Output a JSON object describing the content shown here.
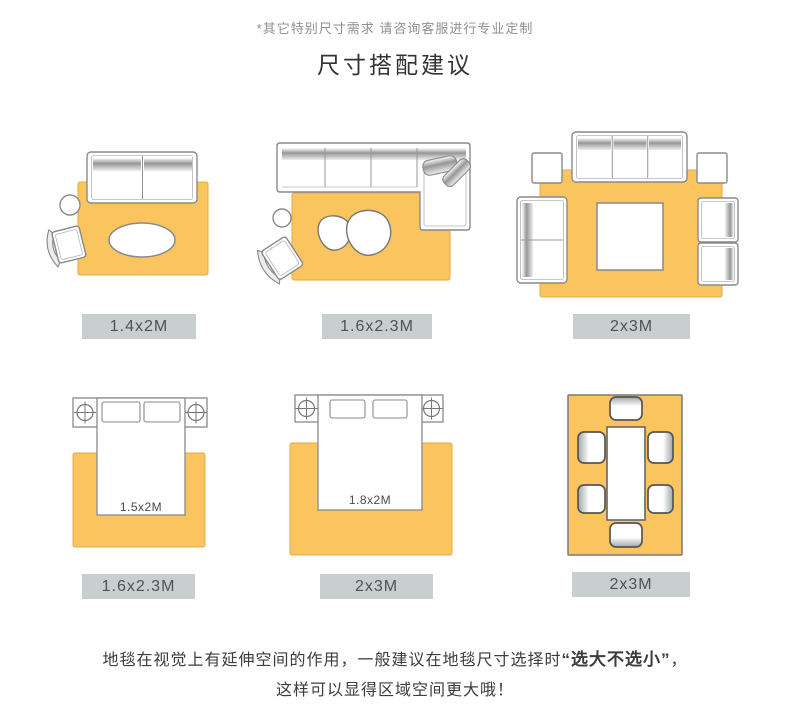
{
  "note": "*其它特别尺寸需求 请咨询客服进行专业定制",
  "title": "尺寸搭配建议",
  "diagrams": [
    {
      "label": "1.4x2M"
    },
    {
      "label": "1.6x2.3M"
    },
    {
      "label": "2x3M"
    },
    {
      "label": "1.6x2.3M",
      "bed_size": "1.5x2M"
    },
    {
      "label": "2x3M",
      "bed_size": "1.8x2M"
    },
    {
      "label": "2x3M"
    }
  ],
  "footer": {
    "line1_prefix": "地毯在视觉上有延伸空间的作用，一般建议在地毯尺寸选择时",
    "line1_bold": "“选大不选小”",
    "line1_suffix": "，",
    "line2": "这样可以显得区域空间更大哦！"
  },
  "colors": {
    "rug_fill": "#FAC55F",
    "rug_border": "#E3AC43",
    "outline_gray": "#8A8A8A",
    "label_bg": "#C9CECE",
    "label_text": "#4D5357"
  }
}
